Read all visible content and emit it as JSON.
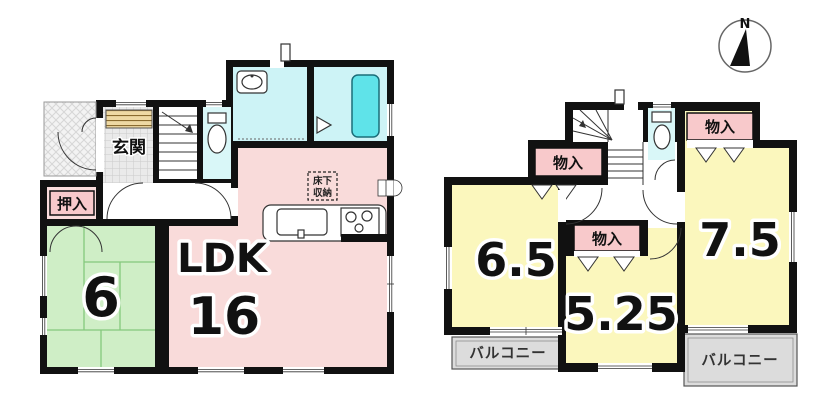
{
  "colors": {
    "wall": "#111111",
    "ldk_pink": "#f9dbda",
    "label_pink": "#f8c9cb",
    "room_yellow": "#fbf7bd",
    "tatami_green": "#cfeec6",
    "wet_room_cyan": "#cdf3f6",
    "bathtub_cyan": "#5fe3e9",
    "balcony_gray": "#dcdcdc",
    "cabinet_tan": "#eed9a4"
  },
  "floor1": {
    "labels": {
      "entrance": "玄関",
      "closet": "押入",
      "tatami_room_size": "6",
      "ldk": "LDK",
      "ldk_size": "16",
      "underfloor_line1": "床下",
      "underfloor_line2": "収納"
    }
  },
  "floor2": {
    "labels": {
      "closet_left": "物入",
      "closet_mid": "物入",
      "closet_right": "物入",
      "room_left_size": "6.5",
      "room_mid_size": "5.25",
      "room_right_size": "7.5",
      "balcony_left": "バルコニー",
      "balcony_right": "バルコニー"
    }
  },
  "compass": {
    "north": "N"
  }
}
